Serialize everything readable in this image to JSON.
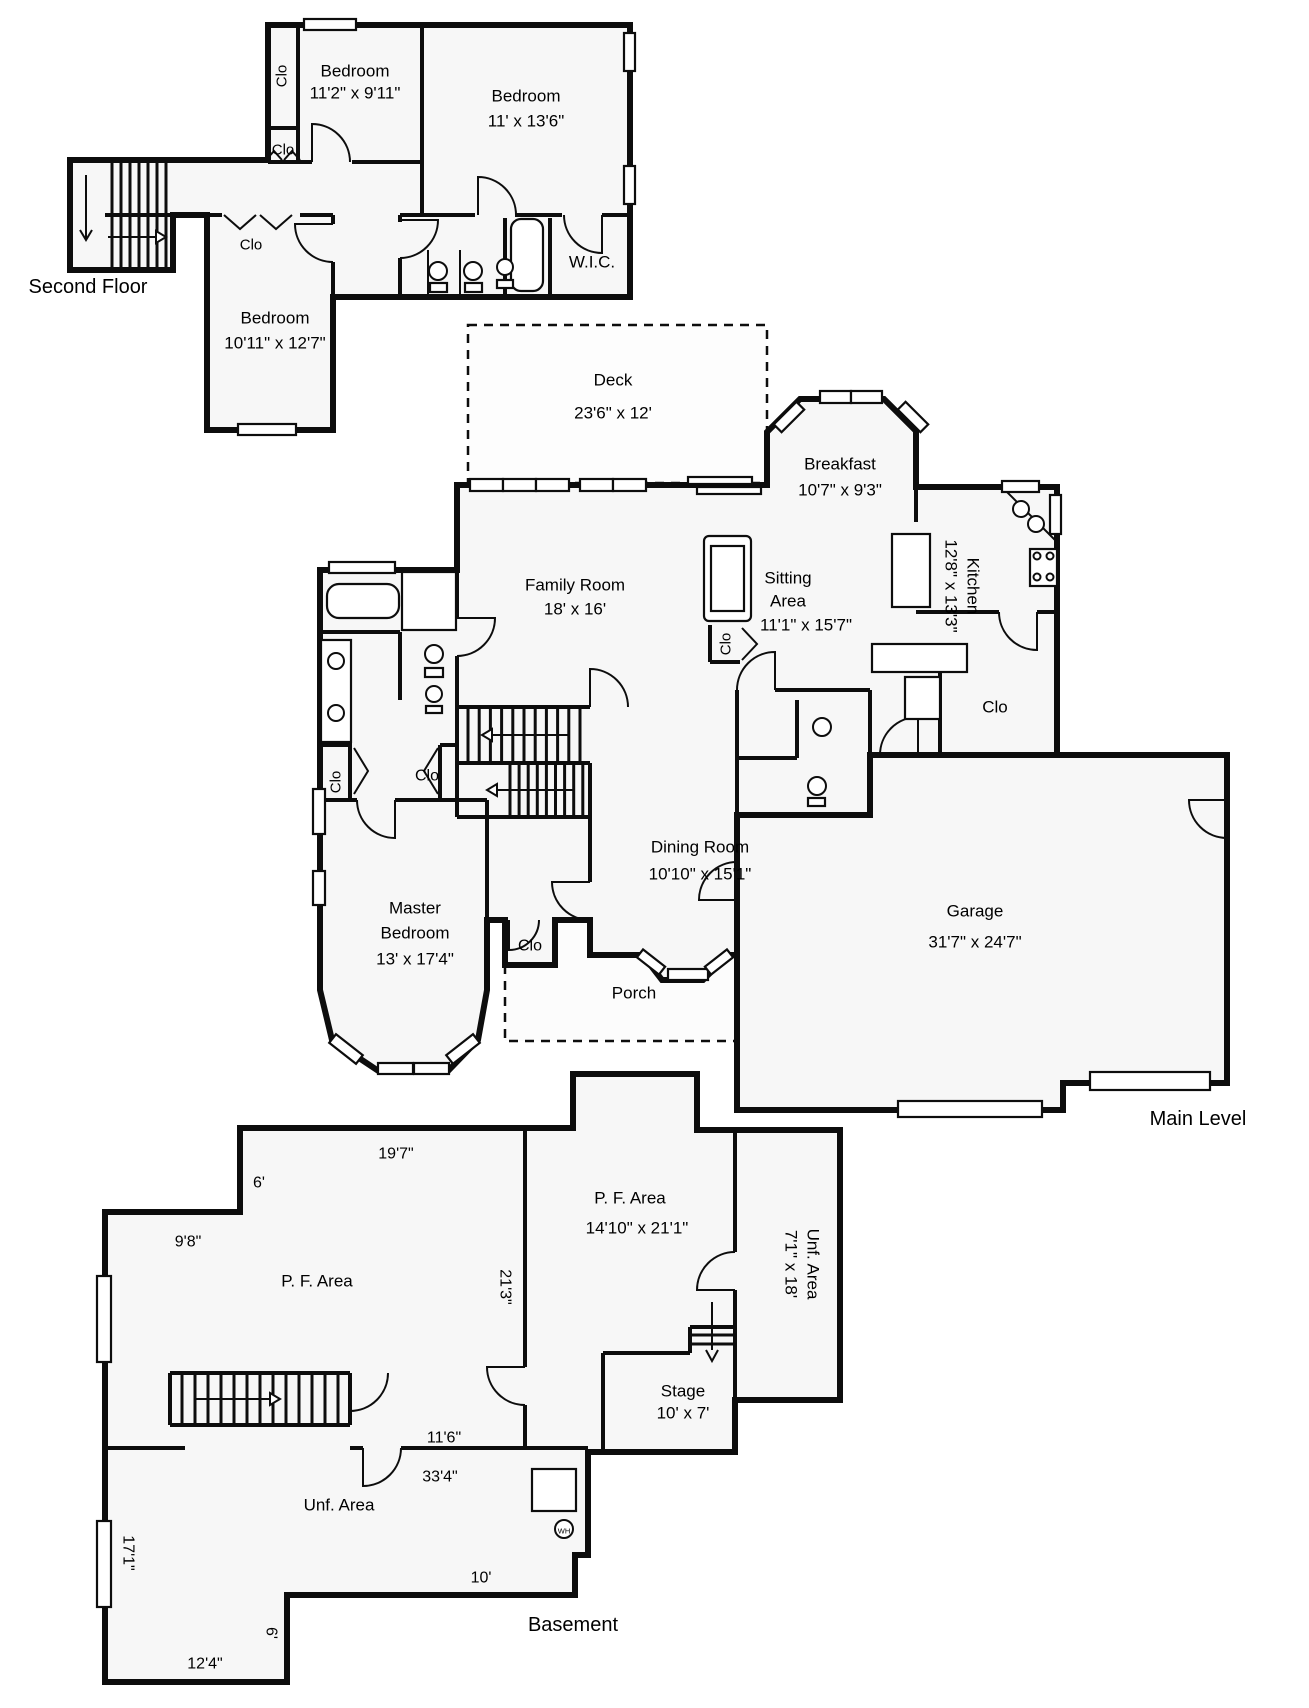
{
  "title": "Floor Plan",
  "style": {
    "background": "#ffffff",
    "wall": "#0d0d0d",
    "room_fill": "#f7f7f7",
    "outdoor_fill": "#fbfbfb",
    "text": "#000000"
  },
  "floors": {
    "second_floor_title": "Second Floor",
    "main_level_title": "Main Level",
    "basement_title": "Basement"
  },
  "labels": [
    {
      "t": "Bedroom",
      "x": 355,
      "y": 71,
      "s": 17,
      "n": "room-label-bedroom1"
    },
    {
      "t": "11'2\" x 9'11\"",
      "x": 355,
      "y": 93,
      "s": 17,
      "n": "dim-bedroom1"
    },
    {
      "t": "Bedroom",
      "x": 526,
      "y": 96,
      "s": 17,
      "n": "room-label-bedroom2"
    },
    {
      "t": "11' x 13'6\"",
      "x": 526,
      "y": 121,
      "s": 17,
      "n": "dim-bedroom2"
    },
    {
      "t": "Bedroom",
      "x": 275,
      "y": 318,
      "s": 17,
      "n": "room-label-bedroom3"
    },
    {
      "t": "10'11\" x 12'7\"",
      "x": 275,
      "y": 343,
      "s": 17,
      "n": "dim-bedroom3"
    },
    {
      "t": "W.I.C.",
      "x": 592,
      "y": 262,
      "s": 17,
      "n": "room-label-wic"
    },
    {
      "t": "Clo",
      "x": 282,
      "y": 76,
      "s": 15,
      "r": -90,
      "n": "label-clo-bed1"
    },
    {
      "t": "Clo",
      "x": 283,
      "y": 150,
      "s": 15,
      "n": "label-clo-hall2f"
    },
    {
      "t": "Clo",
      "x": 251,
      "y": 245,
      "s": 15,
      "n": "label-clo-bed3"
    },
    {
      "t": "Second Floor",
      "x": 88,
      "y": 287,
      "s": 20,
      "n": "floor-title-second"
    },
    {
      "t": "Deck",
      "x": 613,
      "y": 380,
      "s": 17,
      "n": "room-label-deck"
    },
    {
      "t": "23'6\" x 12'",
      "x": 613,
      "y": 413,
      "s": 17,
      "n": "dim-deck"
    },
    {
      "t": "Family Room",
      "x": 575,
      "y": 585,
      "s": 17,
      "n": "room-label-family"
    },
    {
      "t": "18' x 16'",
      "x": 575,
      "y": 609,
      "s": 17,
      "n": "dim-family"
    },
    {
      "t": "Breakfast",
      "x": 840,
      "y": 464,
      "s": 17,
      "n": "room-label-breakfast"
    },
    {
      "t": "10'7\" x 9'3\"",
      "x": 840,
      "y": 490,
      "s": 17,
      "n": "dim-breakfast"
    },
    {
      "t": "Sitting",
      "x": 788,
      "y": 578,
      "s": 17,
      "n": "room-label-sitting1"
    },
    {
      "t": "Area",
      "x": 788,
      "y": 601,
      "s": 17,
      "n": "room-label-sitting2"
    },
    {
      "t": "11'1\" x 15'7\"",
      "x": 806,
      "y": 625,
      "s": 17,
      "n": "dim-sitting"
    },
    {
      "t": "Kitchen",
      "x": 973,
      "y": 586,
      "s": 17,
      "r": 90,
      "n": "room-label-kitchen"
    },
    {
      "t": "12'8\" x 13'3\"",
      "x": 951,
      "y": 586,
      "s": 17,
      "r": 90,
      "n": "dim-kitchen"
    },
    {
      "t": "Clo",
      "x": 995,
      "y": 707,
      "s": 17,
      "n": "label-clo-kitchen"
    },
    {
      "t": "Clo",
      "x": 726,
      "y": 644,
      "s": 15,
      "r": -90,
      "n": "label-clo-sitting"
    },
    {
      "t": "Clo",
      "x": 336,
      "y": 782,
      "s": 15,
      "r": -90,
      "n": "label-clo-bath"
    },
    {
      "t": "Clo",
      "x": 427,
      "y": 776,
      "s": 16,
      "n": "label-clo-masterhall"
    },
    {
      "t": "Dining Room",
      "x": 700,
      "y": 847,
      "s": 17,
      "n": "room-label-dining"
    },
    {
      "t": "10'10\" x 15'1\"",
      "x": 700,
      "y": 874,
      "s": 17,
      "n": "dim-dining"
    },
    {
      "t": "Master",
      "x": 415,
      "y": 908,
      "s": 17,
      "n": "room-label-master1"
    },
    {
      "t": "Bedroom",
      "x": 415,
      "y": 933,
      "s": 17,
      "n": "room-label-master2"
    },
    {
      "t": "13' x 17'4\"",
      "x": 415,
      "y": 959,
      "s": 17,
      "n": "dim-master"
    },
    {
      "t": "Clo",
      "x": 530,
      "y": 946,
      "s": 16,
      "n": "label-clo-master"
    },
    {
      "t": "Porch",
      "x": 634,
      "y": 993,
      "s": 17,
      "n": "room-label-porch"
    },
    {
      "t": "Garage",
      "x": 975,
      "y": 911,
      "s": 17,
      "n": "room-label-garage"
    },
    {
      "t": "31'7\" x 24'7\"",
      "x": 975,
      "y": 942,
      "s": 17,
      "n": "dim-garage"
    },
    {
      "t": "Main Level",
      "x": 1198,
      "y": 1119,
      "s": 20,
      "n": "floor-title-main"
    },
    {
      "t": "19'7\"",
      "x": 396,
      "y": 1154,
      "s": 16,
      "n": "dim-197"
    },
    {
      "t": "6'",
      "x": 259,
      "y": 1183,
      "s": 16,
      "n": "dim-6a"
    },
    {
      "t": "9'8\"",
      "x": 188,
      "y": 1242,
      "s": 16,
      "n": "dim-98"
    },
    {
      "t": "P. F. Area",
      "x": 317,
      "y": 1281,
      "s": 17,
      "n": "room-label-pf-left"
    },
    {
      "t": "21'3\"",
      "x": 505,
      "y": 1287,
      "s": 16,
      "r": 90,
      "n": "dim-213"
    },
    {
      "t": "P. F. Area",
      "x": 630,
      "y": 1198,
      "s": 17,
      "n": "room-label-pf-mid"
    },
    {
      "t": "14'10\" x 21'1\"",
      "x": 637,
      "y": 1228,
      "s": 17,
      "n": "dim-pf-mid"
    },
    {
      "t": "Unf. Area",
      "x": 813,
      "y": 1264,
      "s": 17,
      "r": 90,
      "n": "room-label-unf-right"
    },
    {
      "t": "7'1\" x 18'",
      "x": 791,
      "y": 1264,
      "s": 17,
      "r": 90,
      "n": "dim-unf-right"
    },
    {
      "t": "Stage",
      "x": 683,
      "y": 1391,
      "s": 17,
      "n": "room-label-stage"
    },
    {
      "t": "10' x 7'",
      "x": 683,
      "y": 1413,
      "s": 17,
      "n": "dim-stage"
    },
    {
      "t": "11'6\"",
      "x": 444,
      "y": 1438,
      "s": 16,
      "n": "dim-116"
    },
    {
      "t": "33'4\"",
      "x": 440,
      "y": 1477,
      "s": 16,
      "n": "dim-334"
    },
    {
      "t": "Unf. Area",
      "x": 339,
      "y": 1505,
      "s": 17,
      "n": "room-label-unf-bottom"
    },
    {
      "t": "10'",
      "x": 481,
      "y": 1578,
      "s": 16,
      "n": "dim-10"
    },
    {
      "t": "17'1\"",
      "x": 128,
      "y": 1553,
      "s": 16,
      "r": 90,
      "n": "dim-171"
    },
    {
      "t": "6'",
      "x": 271,
      "y": 1633,
      "s": 16,
      "r": 90,
      "n": "dim-6b"
    },
    {
      "t": "12'4\"",
      "x": 205,
      "y": 1664,
      "s": 16,
      "n": "dim-124"
    },
    {
      "t": "Basement",
      "x": 573,
      "y": 1625,
      "s": 20,
      "n": "floor-title-basement"
    },
    {
      "t": "WH",
      "x": 564,
      "y": 1531,
      "s": 7.5,
      "n": "label-wh"
    }
  ],
  "geometry": {
    "fills": [
      {
        "d": "M468,325 L767,325 L767,483 L468,483 Z",
        "c": "#fdfdfd",
        "n": "deck-area"
      },
      {
        "d": "M505,920 L590,920 L590,955 L641,955 L645,958 L662,980 L703,980 L728,955 L737,955 L737,1041 L505,1041 Z",
        "c": "#fcfcfc",
        "n": "porch-area"
      },
      {
        "d": "M70,160 L268,160 L268,25 L630,25 L630,297 L333,297 L333,430 L207,430 L207,215 L173,215 L173,270 L70,270 Z",
        "n": "second-floor-area"
      },
      {
        "d": "M457,485 L767,485 L767,432 L800,399 L884,399 L916,431 L916,487 L1057,487 L1057,755 L870,755 L870,815 L737,815 L737,955 L728,955 L703,980 L662,980 L645,958 L641,955 L590,955 L590,920 L555,920 L555,965 L505,965 L505,920 L487,920 L487,990 L478,1040 L447,1072 L380,1072 L332,1040 L320,990 L320,570 L457,570 Z",
        "n": "main-level-area"
      },
      {
        "d": "M870,755 L1227,755 L1227,1083 L1063,1083 L1063,1110 L737,1110 L737,815 L870,815 Z",
        "n": "garage-area"
      },
      {
        "d": "M240,1128 L573,1128 L573,1074 L697,1074 L697,1130 L840,1130 L840,1400 L735,1400 L735,1452 L588,1452 L588,1555 L575,1555 L575,1595 L287,1595 L287,1682 L105,1682 L105,1212 L240,1212 Z",
        "n": "basement-area"
      }
    ],
    "dashed": [
      "M468,325 L767,325 L767,483 L468,483 Z",
      "M505,965 L505,1041 L737,1041"
    ],
    "outer": [
      "M70,160 L268,160 L268,25 L630,25 L630,297 L333,297 L333,430 L207,430 L207,215 L173,215 L173,270 L70,270 Z",
      "M457,485 L767,485 L767,432 L800,399 L884,399 L916,431 L916,487 L1057,487 L1057,755 L870,755 L870,815 L737,815 L737,955 L728,955 L703,980 L662,980 L645,958 L641,955 L590,955 L590,920 L555,920 L555,965 L505,965 L505,920 L487,920 L487,990 L478,1040 L447,1072 L380,1072 L332,1040 L320,990 L320,570 L457,570 Z",
      "M870,755 L1227,755 L1227,1083 L1063,1083 L1063,1110 L737,1110 L737,815 L870,815 Z",
      "M240,1128 L573,1128 L573,1074 L697,1074 L697,1130 L840,1130 L840,1400 L735,1400 L735,1452 L588,1452 L588,1555 L575,1555 L575,1595 L287,1595 L287,1682 L105,1682 L105,1212 L240,1212 Z"
    ],
    "inner": [
      "M298,25 L298,160",
      "M268,128 L298,128",
      "M422,25 L422,215",
      "M268,162 L312,162",
      "M352,162 L422,162",
      "M400,215 L400,222",
      "M400,258 L400,297",
      "M400,215 L475,215",
      "M515,215 L562,215",
      "M602,215 L630,215",
      "M505,218 L505,297",
      "M550,218 L550,297",
      "M207,215 L222,215",
      "M300,215 L333,215",
      "M333,215 L333,224",
      "M333,262 L333,297",
      "M105,215 L173,215",
      "M457,570 L457,618",
      "M457,656 L457,817",
      "M320,632 L400,632",
      "M400,632 L400,700",
      "M320,745 L352,745",
      "M440,745 L457,745",
      "M350,745 L350,800",
      "M440,745 L440,800",
      "M320,800 L357,800",
      "M395,800 L487,800",
      "M487,800 L487,920",
      "M457,707 L590,707",
      "M457,817 L590,817",
      "M590,763 L590,817",
      "M457,763 L590,763",
      "M590,817 L590,882",
      "M916,612 L999,612",
      "M1037,612 L1057,612",
      "M916,487 L916,522",
      "M940,655 L940,755",
      "M775,690 L870,690",
      "M737,690 L737,862",
      "M737,900 L737,955",
      "M797,700 L797,758",
      "M737,758 L797,758",
      "M870,690 L870,755",
      "M710,625 L710,662",
      "M710,662 L740,662",
      "M525,1128 L525,1367",
      "M525,1405 L525,1448",
      "M105,1448 L185,1448",
      "M350,1448 L363,1448",
      "M401,1448 L588,1448",
      "M735,1130 L735,1252",
      "M735,1290 L735,1452",
      "M603,1353 L603,1452",
      "M603,1353 L690,1353",
      "M690,1327 L690,1353",
      "M690,1327 L735,1327",
      "M170,1373 L350,1373",
      "M170,1425 L350,1425",
      "M170,1373 L170,1425",
      "M350,1373 L350,1425"
    ],
    "treads": [
      {
        "axis": "x",
        "o": 112,
        "s": 9,
        "n": 7,
        "a": 163,
        "b": 267
      },
      {
        "axis": "x",
        "o": 468,
        "s": 11.2,
        "n": 11,
        "a": 709,
        "b": 761
      },
      {
        "axis": "x",
        "o": 510,
        "s": 9.1,
        "n": 9,
        "a": 765,
        "b": 815
      },
      {
        "axis": "x",
        "o": 182,
        "s": 13,
        "n": 13,
        "a": 1375,
        "b": 1423
      },
      {
        "axis": "y",
        "o": 1335,
        "s": 9,
        "n": 2,
        "a": 690,
        "b": 735
      }
    ],
    "thin": [
      "M224,215 L240,229 L256,215",
      "M260,215 L276,229 L292,215",
      "M266,160 L274,151 L282,160",
      "M284,160 L292,151 L300,160",
      "M354,748 L368,771 L354,794",
      "M438,748 L424,771 L438,794",
      "M742,628 L757,644 L742,660",
      "M404,575 L454,628",
      "M454,575 L404,628",
      "M1004,489 L1056,541",
      "M330,19 L330,30",
      "M267,424 L267,435",
      "M362,562 L362,573",
      "M97,1319 L111,1319",
      "M97,1564 L111,1564",
      "M428,250 L428,297",
      "M460,250 L460,297"
    ],
    "windows": [
      {
        "x": 304,
        "y": 19,
        "w": 52,
        "h": 11
      },
      {
        "x": 624,
        "y": 33,
        "w": 11,
        "h": 38
      },
      {
        "x": 624,
        "y": 166,
        "w": 11,
        "h": 38
      },
      {
        "x": 238,
        "y": 424,
        "w": 58,
        "h": 11
      },
      {
        "x": 470,
        "y": 479,
        "w": 33,
        "h": 12
      },
      {
        "x": 503,
        "y": 479,
        "w": 33,
        "h": 12
      },
      {
        "x": 536,
        "y": 479,
        "w": 33,
        "h": 12
      },
      {
        "x": 580,
        "y": 479,
        "w": 33,
        "h": 12
      },
      {
        "x": 613,
        "y": 479,
        "w": 33,
        "h": 12
      },
      {
        "x": 688,
        "y": 477,
        "w": 64,
        "h": 7
      },
      {
        "x": 697,
        "y": 487,
        "w": 64,
        "h": 7
      },
      {
        "x": 820,
        "y": 391,
        "w": 31,
        "h": 12
      },
      {
        "x": 851,
        "y": 391,
        "w": 31,
        "h": 12
      },
      {
        "cx": 789,
        "cy": 417,
        "w": 32,
        "h": 11,
        "r": -45
      },
      {
        "cx": 913,
        "cy": 417,
        "w": 32,
        "h": 11,
        "r": 45
      },
      {
        "x": 1002,
        "y": 481,
        "w": 37,
        "h": 11
      },
      {
        "x": 1050,
        "y": 495,
        "w": 11,
        "h": 39
      },
      {
        "x": 313,
        "y": 789,
        "w": 12,
        "h": 45
      },
      {
        "x": 313,
        "y": 871,
        "w": 12,
        "h": 34
      },
      {
        "x": 378,
        "y": 1063,
        "w": 35,
        "h": 11
      },
      {
        "x": 414,
        "y": 1063,
        "w": 35,
        "h": 11
      },
      {
        "cx": 346,
        "cy": 1049,
        "w": 34,
        "h": 11,
        "r": 38
      },
      {
        "cx": 463,
        "cy": 1049,
        "w": 34,
        "h": 11,
        "r": -38
      },
      {
        "x": 668,
        "y": 969,
        "w": 40,
        "h": 11
      },
      {
        "cx": 651,
        "cy": 962,
        "w": 28,
        "h": 10,
        "r": 38
      },
      {
        "cx": 719,
        "cy": 962,
        "w": 28,
        "h": 10,
        "r": -38
      },
      {
        "x": 329,
        "y": 562,
        "w": 66,
        "h": 11
      },
      {
        "x": 1090,
        "y": 1072,
        "w": 120,
        "h": 18
      },
      {
        "x": 898,
        "y": 1101,
        "w": 144,
        "h": 16
      },
      {
        "x": 97,
        "y": 1276,
        "w": 14,
        "h": 86
      },
      {
        "x": 97,
        "y": 1521,
        "w": 14,
        "h": 86
      }
    ],
    "doors": [
      "M312,162 L312,124 A38,38 0 0 1 350,162",
      "M478,215 L478,177 A38,38 0 0 1 516,215",
      "M400,220 L438,220 A38,38 0 0 1 400,258",
      "M602,215 L602,253 A38,38 0 0 1 564,215",
      "M333,224 L295,224 A38,38 0 0 0 333,262",
      "M590,707 L590,669 A38,38 0 0 1 628,707",
      "M457,618 L495,618 A38,38 0 0 1 457,656",
      "M1037,612 L1037,650 A38,38 0 0 1 999,612",
      "M1227,800 L1189,800 A38,38 0 0 0 1227,838",
      "M395,800 L395,838 A38,38 0 0 1 357,800",
      "M590,882 L552,882 A38,38 0 0 0 590,920",
      "M775,690 L775,652 A38,38 0 0 0 737,690",
      "M918,755 L918,717 A38,38 0 0 0 880,755",
      "M737,900 L699,900 A38,38 0 0 1 737,862",
      "M509,920 L509,950 A30,30 0 0 0 539,920",
      "M525,1367 L487,1367 A38,38 0 0 0 525,1405",
      "M363,1448 L363,1486 A38,38 0 0 0 401,1448",
      "M735,1290 L697,1290 A38,38 0 0 1 735,1252",
      "M350,1373 L350,1411 A38,38 0 0 0 388,1373"
    ],
    "arrows": [
      {
        "d": "M86,175 L86,238",
        "h": "M80,230 L86,240 L92,230",
        "open": true
      },
      {
        "d": "M108,237 L156,237",
        "h": "M156,231 L166,237 L156,243 Z"
      },
      {
        "d": "M570,735 L492,735",
        "h": "M492,729 L482,735 L492,741 Z"
      },
      {
        "d": "M575,790 L497,790",
        "h": "M497,784 L487,790 L497,796 Z"
      },
      {
        "d": "M196,1399 L270,1399",
        "h": "M270,1393 L280,1399 L270,1405 Z"
      },
      {
        "d": "M712,1302 L712,1350",
        "h": "M706,1350 L712,1361 L718,1350",
        "open": true
      }
    ],
    "frects": [
      {
        "x": 511,
        "y": 219,
        "w": 32,
        "h": 72,
        "rx": 10,
        "n": "bathtub-icon"
      },
      {
        "x": 327,
        "y": 584,
        "w": 72,
        "h": 34,
        "rx": 12,
        "n": "bathtub-icon"
      },
      {
        "x": 402,
        "y": 572,
        "w": 54,
        "h": 58,
        "n": "shower-icon"
      },
      {
        "x": 892,
        "y": 534,
        "w": 38,
        "h": 73,
        "n": "island-counter"
      },
      {
        "x": 704,
        "y": 536,
        "w": 47,
        "h": 85,
        "rx": 5,
        "n": "sofa-icon"
      },
      {
        "x": 711,
        "y": 546,
        "w": 33,
        "h": 65,
        "n": "sofa-icon"
      },
      {
        "x": 872,
        "y": 644,
        "w": 95,
        "h": 28,
        "n": "counter"
      },
      {
        "x": 905,
        "y": 677,
        "w": 35,
        "h": 42,
        "n": "fridge-icon"
      },
      {
        "x": 1030,
        "y": 549,
        "w": 27,
        "h": 37,
        "n": "stove-icon"
      },
      {
        "x": 532,
        "y": 1469,
        "w": 44,
        "h": 42,
        "n": "furnace-icon"
      },
      {
        "x": 430,
        "y": 283,
        "w": 17,
        "h": 9,
        "n": "toilet-tank"
      },
      {
        "x": 465,
        "y": 283,
        "w": 17,
        "h": 9,
        "n": "toilet-tank"
      },
      {
        "x": 497,
        "y": 280,
        "w": 16,
        "h": 8,
        "n": "sink-base"
      },
      {
        "x": 425,
        "y": 668,
        "w": 18,
        "h": 9,
        "n": "toilet-tank"
      },
      {
        "x": 426,
        "y": 706,
        "w": 16,
        "h": 7,
        "n": "sink-base"
      },
      {
        "x": 808,
        "y": 798,
        "w": 17,
        "h": 8,
        "n": "toilet-tank"
      },
      {
        "x": 321,
        "y": 640,
        "w": 30,
        "h": 102,
        "n": "vanity-counter"
      }
    ],
    "circles": [
      {
        "cx": 438,
        "cy": 271,
        "r": 9,
        "n": "toilet-icon"
      },
      {
        "cx": 473,
        "cy": 271,
        "r": 9,
        "n": "toilet-icon"
      },
      {
        "cx": 505,
        "cy": 267,
        "r": 8,
        "n": "sink-icon"
      },
      {
        "cx": 434,
        "cy": 654,
        "r": 9,
        "n": "toilet-icon"
      },
      {
        "cx": 434,
        "cy": 694,
        "r": 8,
        "n": "sink-icon"
      },
      {
        "cx": 336,
        "cy": 661,
        "r": 8,
        "n": "sink-icon"
      },
      {
        "cx": 336,
        "cy": 713,
        "r": 8,
        "n": "sink-icon"
      },
      {
        "cx": 1021,
        "cy": 509,
        "r": 8,
        "n": "sink-icon"
      },
      {
        "cx": 1036,
        "cy": 524,
        "r": 8,
        "n": "sink-icon"
      },
      {
        "cx": 822,
        "cy": 727,
        "r": 9,
        "n": "sink-icon"
      },
      {
        "cx": 817,
        "cy": 786,
        "r": 9,
        "n": "toilet-icon"
      },
      {
        "cx": 564,
        "cy": 1529,
        "r": 9,
        "n": "water-heater-icon"
      },
      {
        "cx": 1037,
        "cy": 556,
        "r": 3.5,
        "n": "burner"
      },
      {
        "cx": 1050,
        "cy": 556,
        "r": 3.5,
        "n": "burner"
      },
      {
        "cx": 1037,
        "cy": 577,
        "r": 3.5,
        "n": "burner"
      },
      {
        "cx": 1050,
        "cy": 577,
        "r": 3.5,
        "n": "burner"
      }
    ]
  }
}
